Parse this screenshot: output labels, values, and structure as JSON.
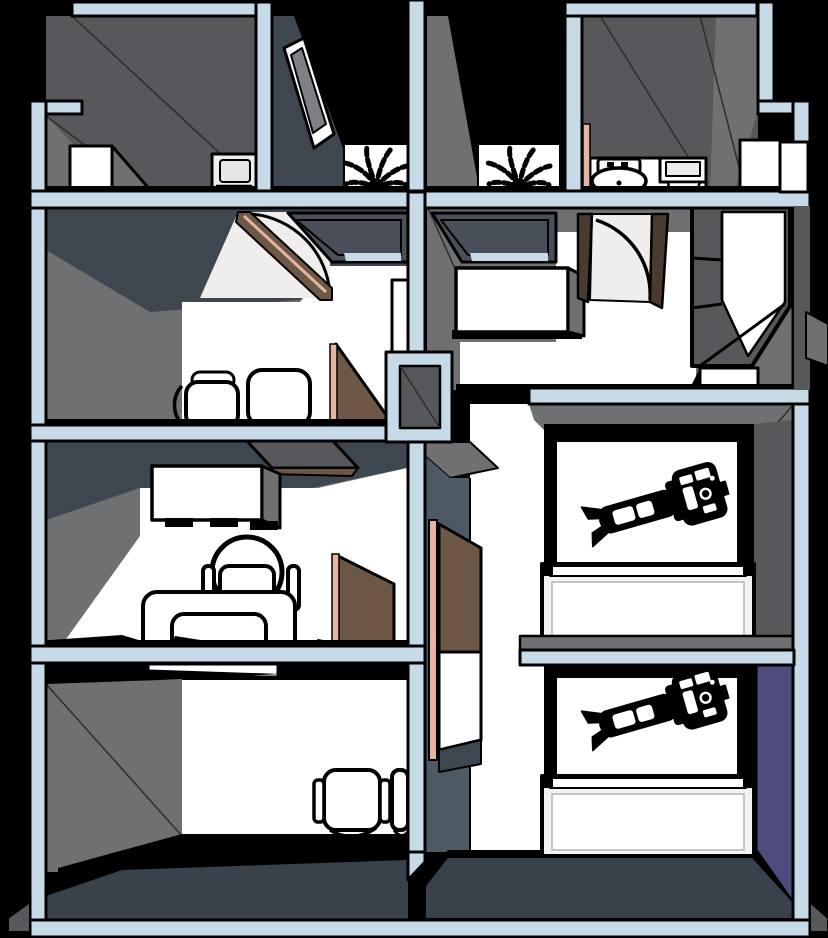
{
  "scene": {
    "kind": "3d-floorplan-cutaway",
    "subject": "clinic-floor-plan",
    "visible_text": ""
  },
  "colors": {
    "background": "#000000",
    "wall_cut": "#c6dbe7",
    "wall_light": "#6f7071",
    "wall_mid": "#57585c",
    "wall_dark": "#3e474f",
    "wall_slate": "#4d5a64",
    "floor_offwhite": "#efeeec",
    "floor_slate": "#39424b",
    "accent_purple": "#4d4c7d",
    "door_brown": "#6d5848",
    "door_brown_dark": "#4a3b30",
    "door_edge_pink": "#e5b5a1",
    "window_glass": "#495059",
    "frame_gray": "#7d8187",
    "counter_trim": "#f2f2f2",
    "outline": "#000000"
  },
  "objects": [
    "storage-box",
    "ramp",
    "wall-appliance",
    "framed-picture",
    "fern-plant",
    "fern-plant",
    "toilet",
    "sink-vanity",
    "bathroom-cabinet",
    "side-cabinet",
    "interior-window",
    "interior-window",
    "swing-door",
    "swing-door",
    "guest-chair",
    "guest-chair",
    "wall-pillar",
    "open-door",
    "wall-shelf",
    "floating-cabinet",
    "office-chair",
    "desk",
    "laptop-silhouette",
    "open-door",
    "reception-shelf",
    "waiting-chair",
    "waiting-chair",
    "entry-door",
    "hallway-bench",
    "tall-cabinet",
    "step-cabinet",
    "corridor-door",
    "dental-chair",
    "clinic-counter",
    "dental-chair",
    "clinic-counter",
    "accent-wall"
  ]
}
